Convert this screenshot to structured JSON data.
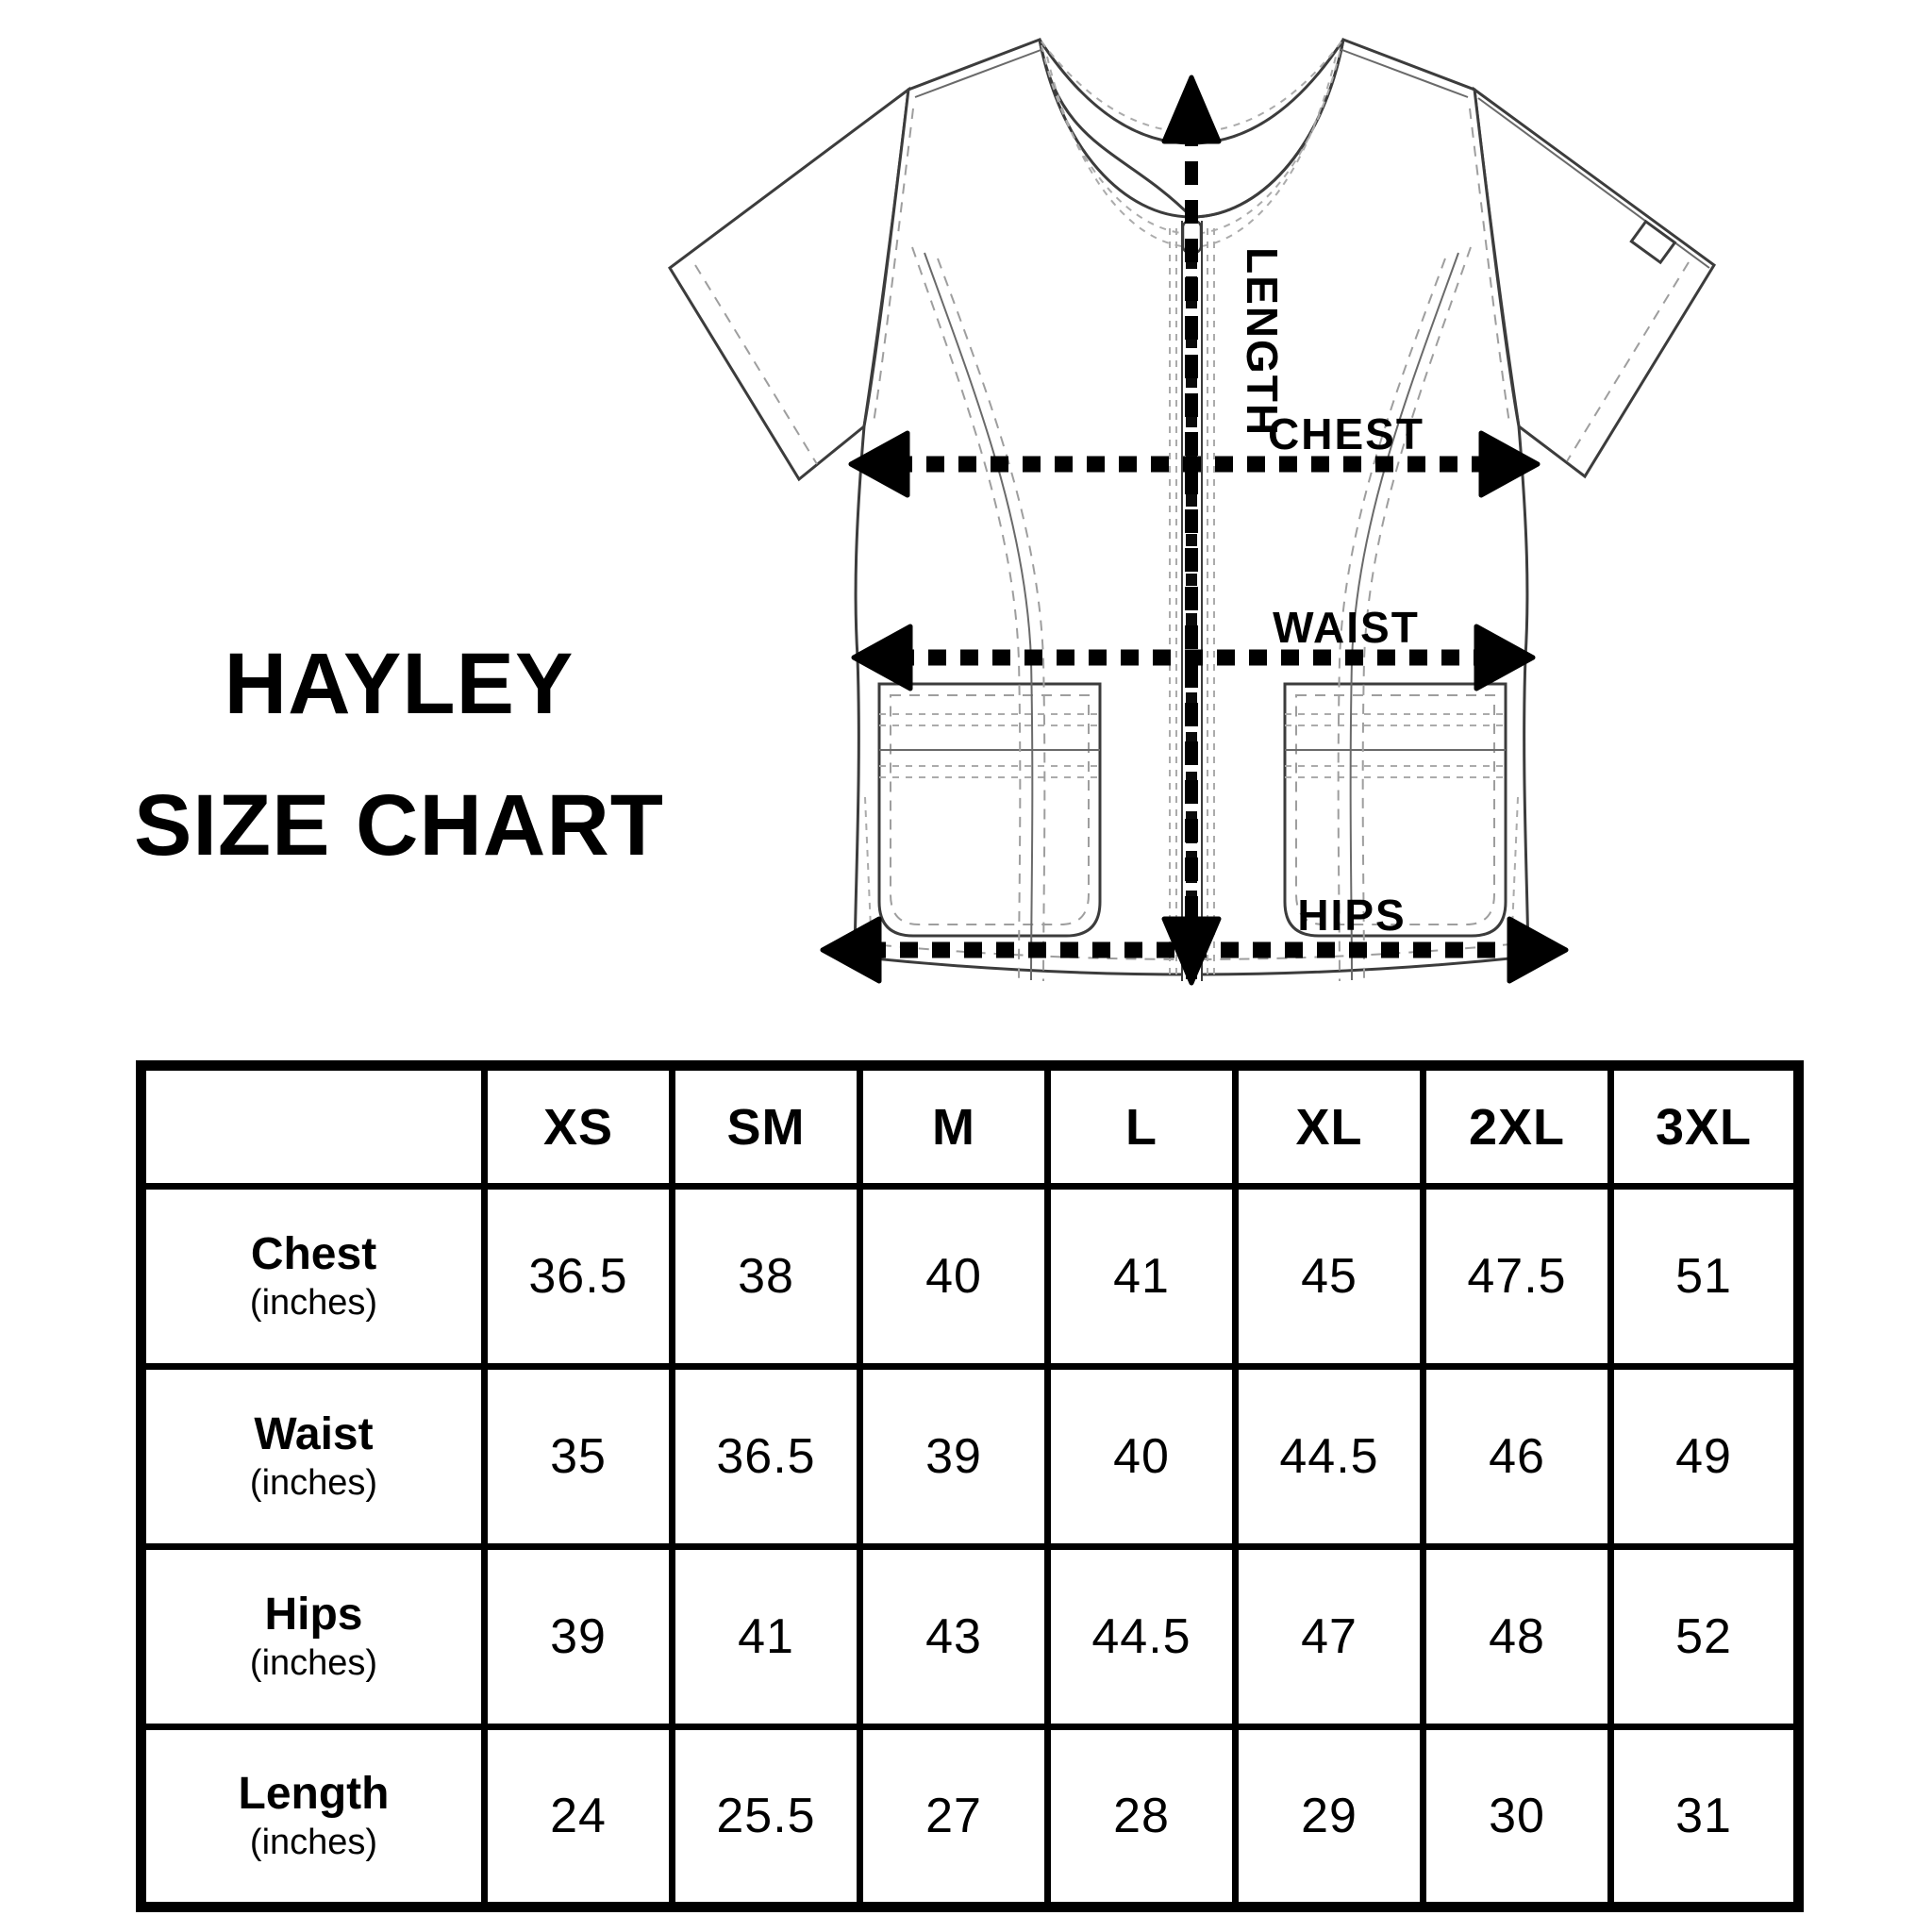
{
  "title": {
    "line1": "HAYLEY",
    "line2": "SIZE CHART"
  },
  "diagram": {
    "description": "scrub-top technical flat sketch with measurement arrows",
    "labels": {
      "length": "LENGTH",
      "chest": "CHEST",
      "waist": "WAIST",
      "hips": "HIPS"
    }
  },
  "table": {
    "columns": [
      "XS",
      "SM",
      "M",
      "L",
      "XL",
      "2XL",
      "3XL"
    ],
    "rows": [
      {
        "label": "Chest",
        "unit": "(inches)",
        "values": [
          "36.5",
          "38",
          "40",
          "41",
          "45",
          "47.5",
          "51"
        ]
      },
      {
        "label": "Waist",
        "unit": "(inches)",
        "values": [
          "35",
          "36.5",
          "39",
          "40",
          "44.5",
          "46",
          "49"
        ]
      },
      {
        "label": "Hips",
        "unit": "(inches)",
        "values": [
          "39",
          "41",
          "43",
          "44.5",
          "47",
          "48",
          "52"
        ]
      },
      {
        "label": "Length",
        "unit": "(inches)",
        "values": [
          "24",
          "25.5",
          "27",
          "28",
          "29",
          "30",
          "31"
        ]
      }
    ]
  },
  "chart_data": {
    "type": "table",
    "title": "HAYLEY SIZE CHART",
    "columns": [
      "XS",
      "SM",
      "M",
      "L",
      "XL",
      "2XL",
      "3XL"
    ],
    "rows": [
      {
        "label": "Chest (inches)",
        "values": [
          36.5,
          38,
          40,
          41,
          45,
          47.5,
          51
        ]
      },
      {
        "label": "Waist (inches)",
        "values": [
          35,
          36.5,
          39,
          40,
          44.5,
          46,
          49
        ]
      },
      {
        "label": "Hips (inches)",
        "values": [
          39,
          41,
          43,
          44.5,
          47,
          48,
          52
        ]
      },
      {
        "label": "Length (inches)",
        "values": [
          24,
          25.5,
          27,
          28,
          29,
          30,
          31
        ]
      }
    ]
  },
  "colors": {
    "ink": "#000000",
    "outline": "#3c3c3c",
    "stitch": "#9e9e9e",
    "background": "#ffffff"
  }
}
